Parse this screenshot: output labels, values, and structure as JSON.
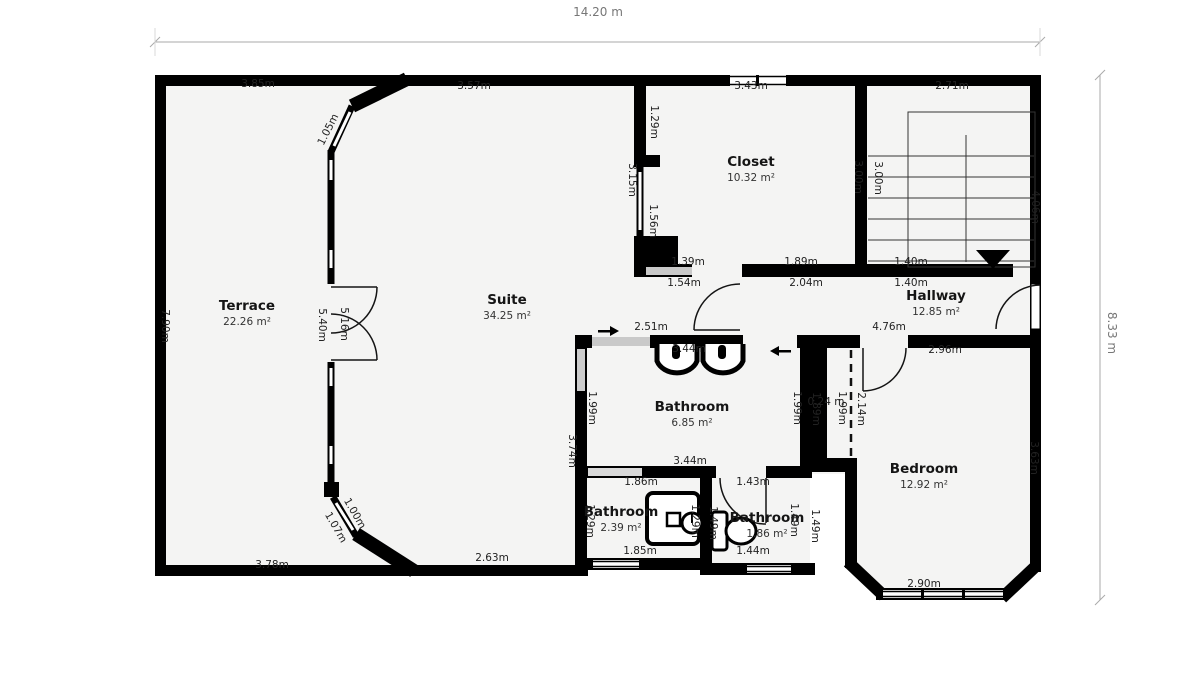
{
  "plan": {
    "overall_width": "14.20 m",
    "overall_height": "8.33 m"
  },
  "rooms": [
    {
      "name": "Terrace",
      "area": "22.26 m²",
      "x": 247,
      "y": 310
    },
    {
      "name": "Suite",
      "area": "34.25 m²",
      "x": 507,
      "y": 304
    },
    {
      "name": "Closet",
      "area": "10.32 m²",
      "x": 751,
      "y": 166
    },
    {
      "name": "Hallway",
      "area": "12.85 m²",
      "x": 936,
      "y": 300
    },
    {
      "name": "Bathroom",
      "area": "6.85 m²",
      "x": 692,
      "y": 411
    },
    {
      "name": "Bathroom",
      "area": "2.39 m²",
      "x": 621,
      "y": 516
    },
    {
      "name": "Bathroom",
      "area": "1.86 m²",
      "x": 767,
      "y": 522
    },
    {
      "name": "Bedroom",
      "area": "12.92 m²",
      "x": 924,
      "y": 473
    }
  ],
  "dims": [
    {
      "text": "14.20 m",
      "x": 598,
      "y": 16,
      "rot": 0,
      "cls": "big"
    },
    {
      "text": "8.33 m",
      "x": 1108,
      "y": 333,
      "rot": 90,
      "cls": "big"
    },
    {
      "text": "3.85m",
      "x": 258,
      "y": 87,
      "rot": 0
    },
    {
      "text": "3.57m",
      "x": 474,
      "y": 89,
      "rot": 0
    },
    {
      "text": "3.43m",
      "x": 751,
      "y": 89,
      "rot": 0
    },
    {
      "text": "2.71m",
      "x": 952,
      "y": 89,
      "rot": 0
    },
    {
      "text": "1.05m",
      "x": 331,
      "y": 131,
      "rot": -63
    },
    {
      "text": "1.29m",
      "x": 651,
      "y": 122,
      "rot": 90
    },
    {
      "text": "3.15m",
      "x": 629,
      "y": 180,
      "rot": 90
    },
    {
      "text": "1.56m",
      "x": 650,
      "y": 221,
      "rot": 90
    },
    {
      "text": "3.00m",
      "x": 855,
      "y": 177,
      "rot": 90
    },
    {
      "text": "3.00m",
      "x": 875,
      "y": 178,
      "rot": 90
    },
    {
      "text": "4.06m",
      "x": 1032,
      "y": 207,
      "rot": 90
    },
    {
      "text": "1.39m",
      "x": 688,
      "y": 265,
      "rot": 0
    },
    {
      "text": "1.89m",
      "x": 801,
      "y": 265,
      "rot": 0
    },
    {
      "text": "1.40m",
      "x": 911,
      "y": 265,
      "rot": 0
    },
    {
      "text": "1.54m",
      "x": 684,
      "y": 286,
      "rot": 0
    },
    {
      "text": "2.04m",
      "x": 806,
      "y": 286,
      "rot": 0
    },
    {
      "text": "1.40m",
      "x": 911,
      "y": 286,
      "rot": 0
    },
    {
      "text": "7.90m",
      "x": 162,
      "y": 326,
      "rot": 90
    },
    {
      "text": "5.40m",
      "x": 319,
      "y": 325,
      "rot": 90
    },
    {
      "text": "5.16m",
      "x": 341,
      "y": 324,
      "rot": 90
    },
    {
      "text": "2.51m",
      "x": 651,
      "y": 330,
      "rot": 0
    },
    {
      "text": "4.76m",
      "x": 889,
      "y": 330,
      "rot": 0
    },
    {
      "text": "2.96m",
      "x": 945,
      "y": 353,
      "rot": 0
    },
    {
      "text": "3.44m",
      "x": 689,
      "y": 352,
      "rot": 0
    },
    {
      "text": "1.99m",
      "x": 589,
      "y": 408,
      "rot": 90
    },
    {
      "text": "1.99m",
      "x": 794,
      "y": 408,
      "rot": 90
    },
    {
      "text": "1.89m",
      "x": 813,
      "y": 409,
      "rot": 90
    },
    {
      "text": "1.99m",
      "x": 839,
      "y": 408,
      "rot": 90
    },
    {
      "text": "2.14m",
      "x": 858,
      "y": 409,
      "rot": 90
    },
    {
      "text": "0.24 m",
      "x": 826,
      "y": 405,
      "rot": 0
    },
    {
      "text": "3.74m",
      "x": 569,
      "y": 451,
      "rot": 90
    },
    {
      "text": "3.63m",
      "x": 1031,
      "y": 458,
      "rot": 90
    },
    {
      "text": "3.44m",
      "x": 690,
      "y": 464,
      "rot": 0
    },
    {
      "text": "1.86m",
      "x": 641,
      "y": 485,
      "rot": 0
    },
    {
      "text": "1.43m",
      "x": 753,
      "y": 485,
      "rot": 0
    },
    {
      "text": "1.29m",
      "x": 587,
      "y": 521,
      "rot": 90
    },
    {
      "text": "1.29m",
      "x": 692,
      "y": 521,
      "rot": 90
    },
    {
      "text": "1.49m",
      "x": 710,
      "y": 523,
      "rot": 90
    },
    {
      "text": "1.49m",
      "x": 791,
      "y": 520,
      "rot": 90
    },
    {
      "text": "1.49m",
      "x": 812,
      "y": 526,
      "rot": 90
    },
    {
      "text": "1.85m",
      "x": 640,
      "y": 554,
      "rot": 0
    },
    {
      "text": "1.44m",
      "x": 753,
      "y": 554,
      "rot": 0
    },
    {
      "text": "2.63m",
      "x": 492,
      "y": 561,
      "rot": 0
    },
    {
      "text": "3.78m",
      "x": 272,
      "y": 568,
      "rot": 0
    },
    {
      "text": "2.90m",
      "x": 924,
      "y": 587,
      "rot": 0
    },
    {
      "text": "1.07m",
      "x": 333,
      "y": 529,
      "rot": 60
    },
    {
      "text": "1.00m",
      "x": 352,
      "y": 515,
      "rot": 60
    }
  ]
}
